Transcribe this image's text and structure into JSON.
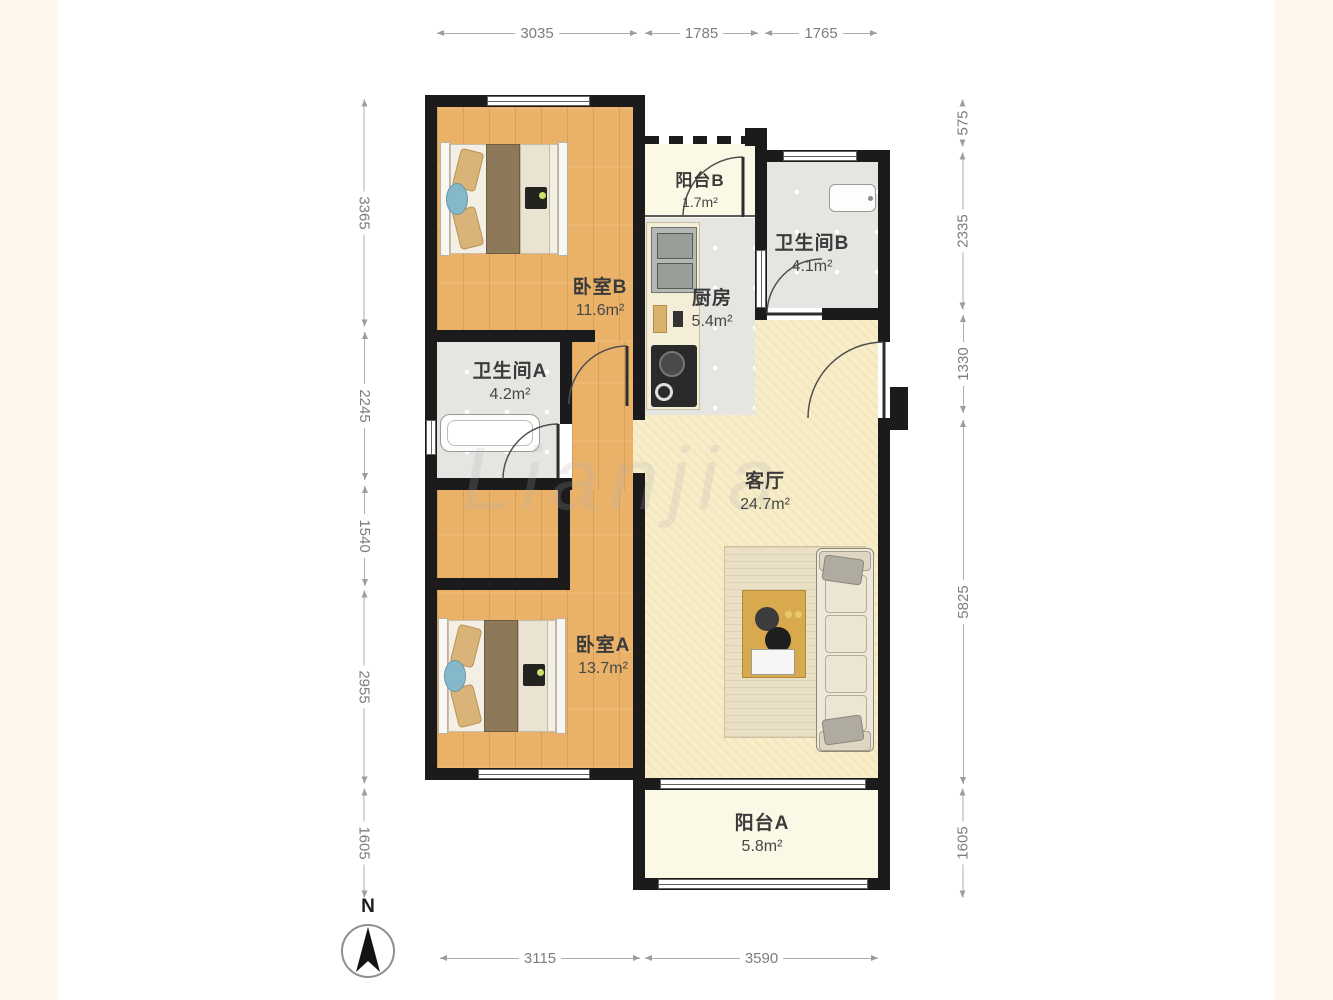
{
  "watermark": "Lianjia",
  "compass": {
    "north_label": "N"
  },
  "rooms": [
    {
      "name": "卧室B",
      "area": "11.6m²"
    },
    {
      "name": "阳台B",
      "area": "1.7m²"
    },
    {
      "name": "卫生间B",
      "area": "4.1m²"
    },
    {
      "name": "厨房",
      "area": "5.4m²"
    },
    {
      "name": "卫生间A",
      "area": "4.2m²"
    },
    {
      "name": "客厅",
      "area": "24.7m²"
    },
    {
      "name": "卧室A",
      "area": "13.7m²"
    },
    {
      "name": "阳台A",
      "area": "5.8m²"
    }
  ],
  "dimensions": {
    "top": [
      "3035",
      "1785",
      "1765"
    ],
    "bottom": [
      "3115",
      "3590"
    ],
    "left": [
      "3365",
      "2245",
      "1540",
      "2955",
      "1605"
    ],
    "right": [
      "575",
      "2335",
      "1330",
      "5825",
      "1605"
    ]
  },
  "colors": {
    "wall": "#1b1b1b",
    "wood_floor": "#eab269",
    "tile_floor": "#e5e5e2",
    "living_floor": "#f7edc9",
    "balcony_floor": "#fbf8e6",
    "dimension_text": "#7d7d7d",
    "label_text": "#3a3a3a"
  }
}
